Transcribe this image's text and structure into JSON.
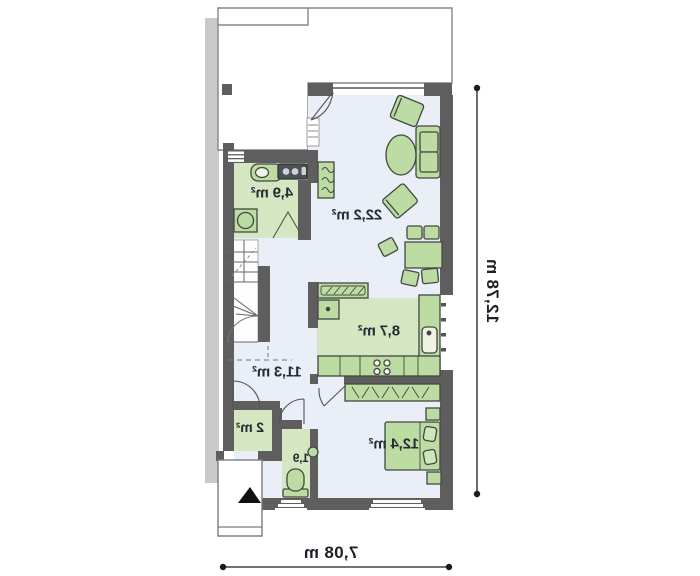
{
  "floor_plan": {
    "type": "mirrored-floor-plan",
    "rooms": [
      {
        "id": "living-room",
        "area": "22,2 m²"
      },
      {
        "id": "bathroom",
        "area": "4,9 m²"
      },
      {
        "id": "kitchen",
        "area": "8,7 m²"
      },
      {
        "id": "hall",
        "area": "11,3 m²"
      },
      {
        "id": "closet",
        "area": "2 m²"
      },
      {
        "id": "wc",
        "area": "1,9"
      },
      {
        "id": "bedroom",
        "area": "12,4 m²"
      }
    ],
    "dimensions": {
      "overall_width": "7,08 m",
      "overall_depth": "12,78 m"
    },
    "colors": {
      "wall": "#5e5e5e",
      "party_wall": "#c9c9c9",
      "floor": "#e9eef7",
      "wet_room_floor": "#d5e6c3",
      "furniture_fill": "#bcdca3",
      "furniture_stroke": "#42483f",
      "dimension_line": "#1c1c1c",
      "label_text": "#272b33"
    }
  }
}
